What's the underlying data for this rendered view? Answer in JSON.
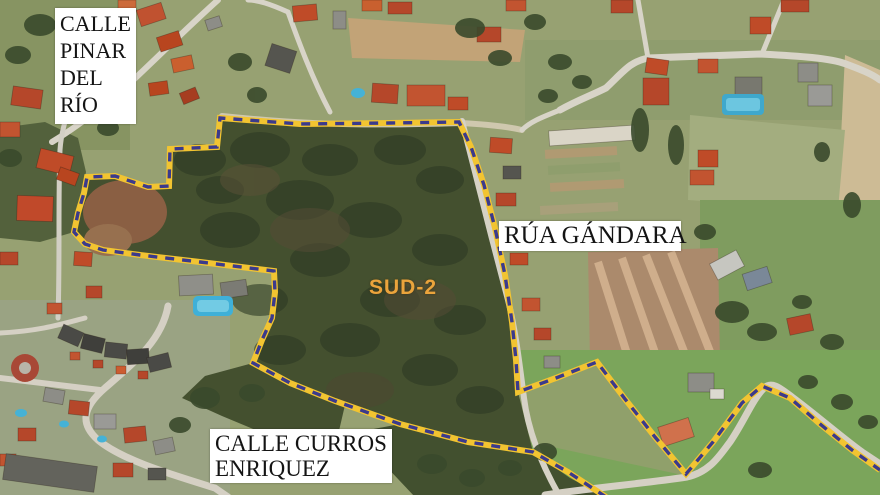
{
  "map": {
    "kind": "aerial-photo-zoning-map",
    "zone": {
      "label": "SUD-2",
      "label_color": "#eba43c"
    },
    "streets": {
      "pinar": {
        "lines": [
          "CALLE",
          "PINAR",
          "DEL",
          "RÍO"
        ]
      },
      "gandara": {
        "lines": [
          "RÚA GÁNDARA"
        ]
      },
      "curros": {
        "lines": [
          "CALLE CURROS",
          "ENRIQUEZ"
        ]
      }
    },
    "boundary": {
      "style": "dashed",
      "dash_color": "#3b3a8c",
      "casing_color": "#f2c431"
    },
    "label_box": {
      "bg": "#ffffff",
      "text": "#141414"
    }
  }
}
